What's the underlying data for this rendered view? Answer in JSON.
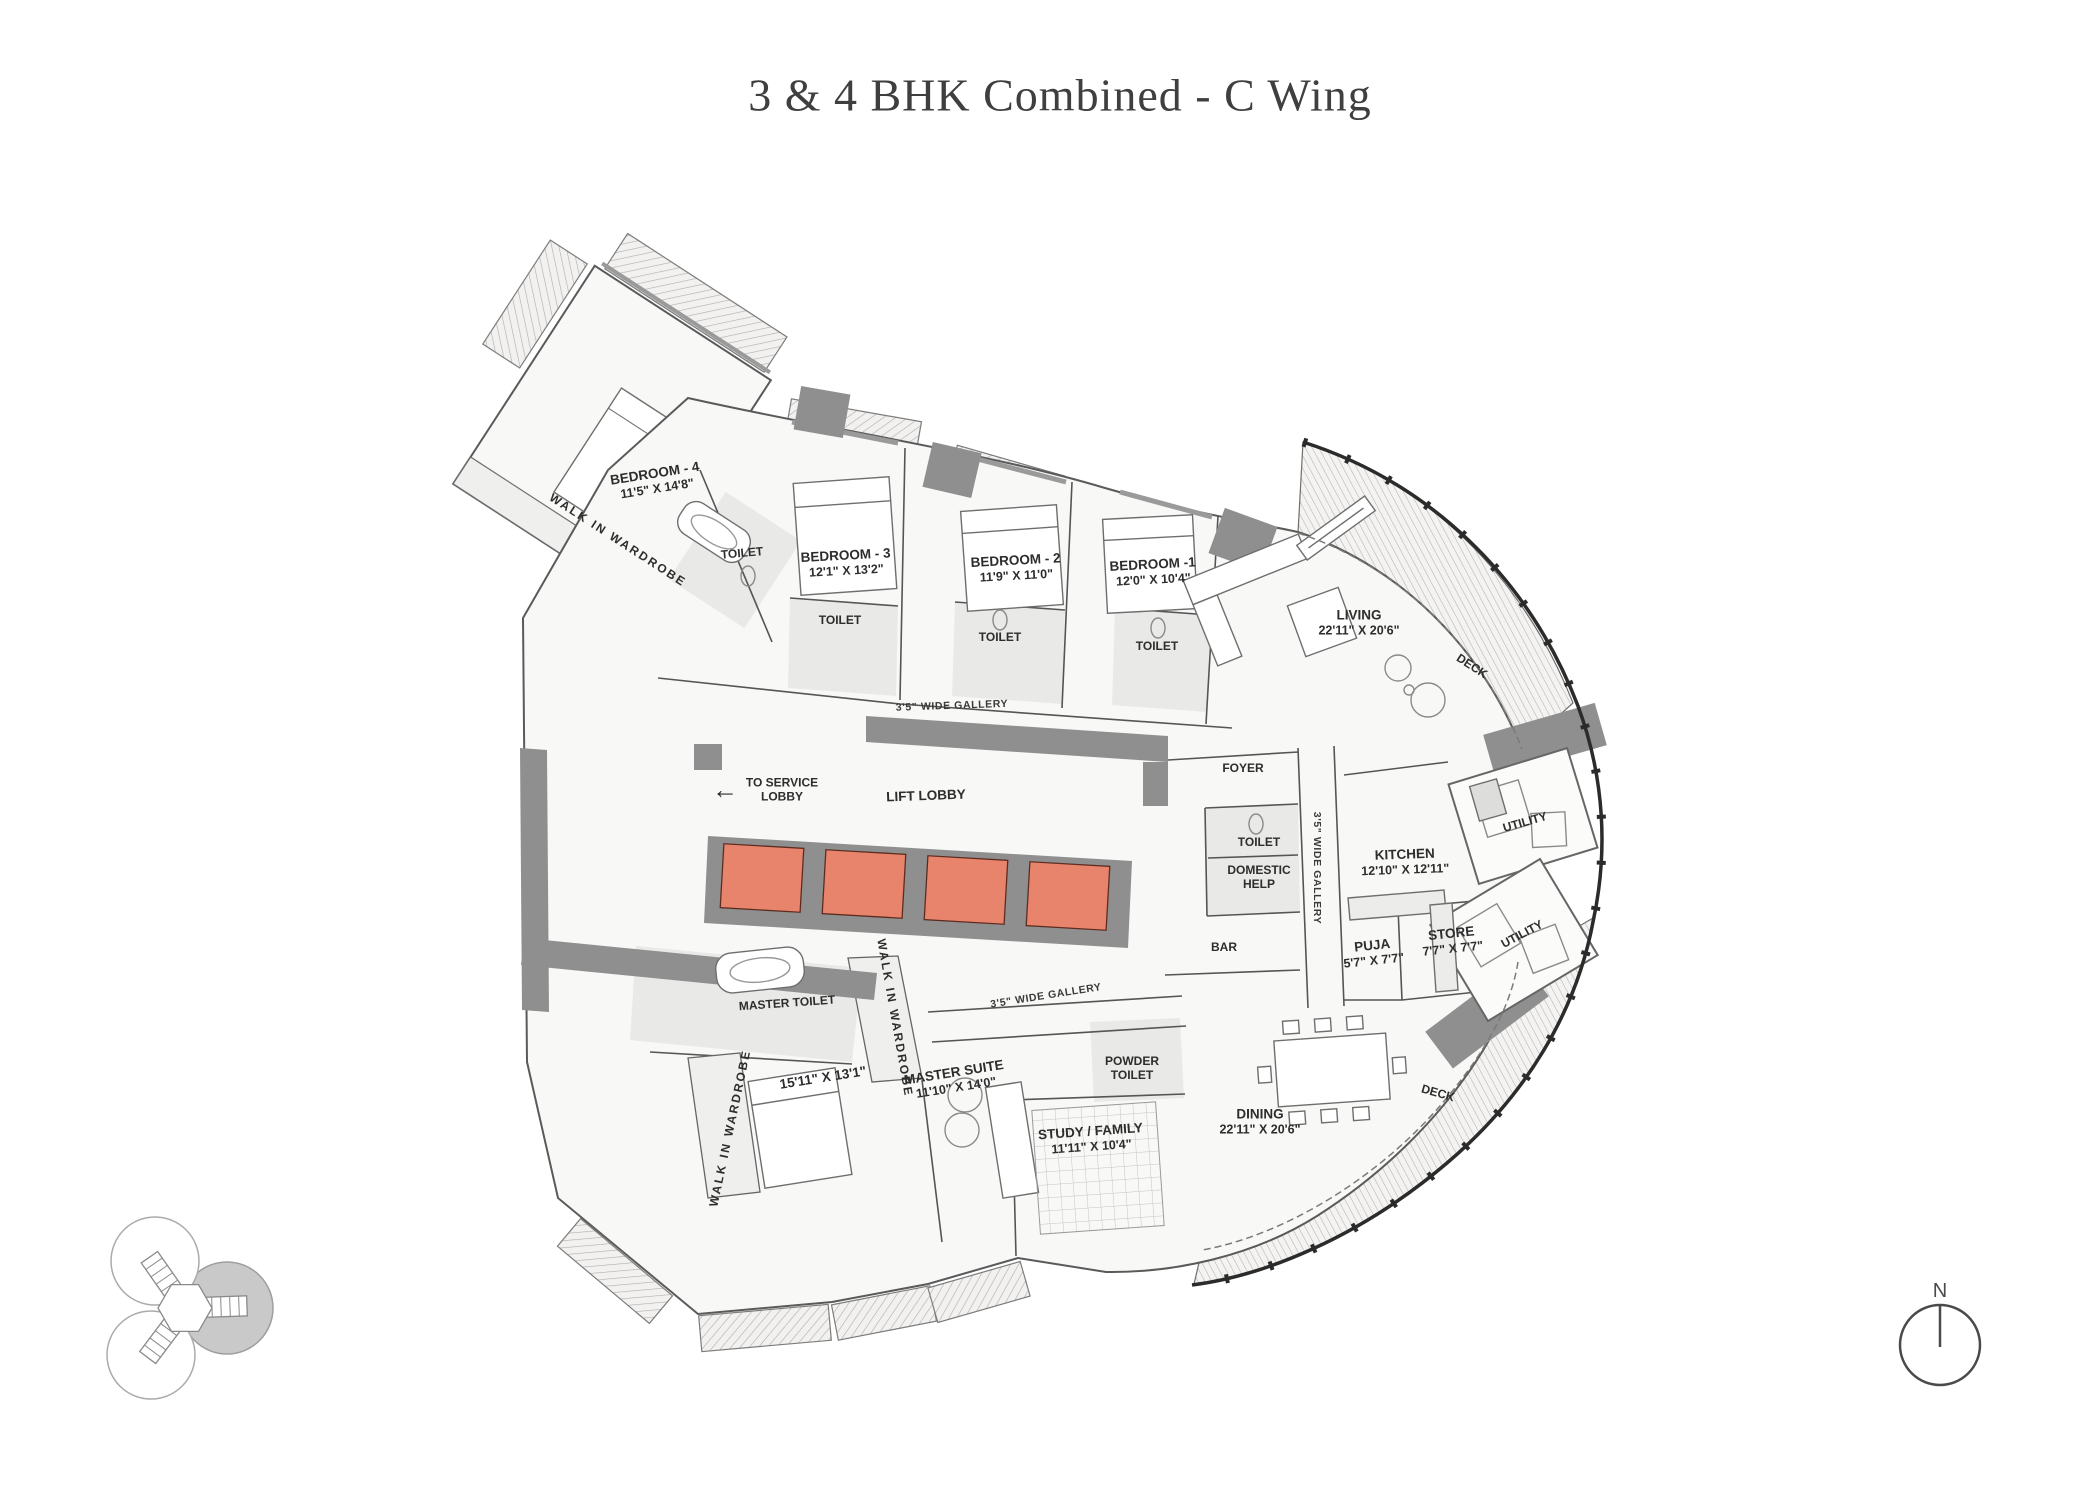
{
  "title": "3 & 4 BHK Combined - C Wing",
  "colors": {
    "lift_highlight": "#E8846B",
    "wall_gray": "#8F8F8F",
    "keyplan_wing_highlight": "#C9C9C9"
  },
  "icons": {
    "service_lobby_arrow": "←"
  },
  "labels": {
    "bedroom4": {
      "name": "BEDROOM - 4",
      "dims": "11'5\" X 14'8\""
    },
    "bedroom3": {
      "name": "BEDROOM - 3",
      "dims": "12'1\" X 13'2\""
    },
    "bedroom2": {
      "name": "BEDROOM - 2",
      "dims": "11'9\" X 11'0\""
    },
    "bedroom1": {
      "name": "BEDROOM -1",
      "dims": "12'0\" X 10'4\""
    },
    "living": {
      "name": "LIVING",
      "dims": "22'11\" X 20'6\""
    },
    "dining": {
      "name": "DINING",
      "dims": "22'11\" X 20'6\""
    },
    "kitchen": {
      "name": "KITCHEN",
      "dims": "12'10\" X 12'11\""
    },
    "store": {
      "name": "STORE",
      "dims": "7'7\" X 7'7\""
    },
    "puja": {
      "name": "PUJA",
      "dims": "5'7\" X 7'7\""
    },
    "master_suite": {
      "name": "MASTER SUITE",
      "dims": "11'10\" X 14'0\""
    },
    "master_bedroom_dims": "15'11\" X 13'1\"",
    "study_family": {
      "name": "STUDY / FAMILY",
      "dims": "11'11\" X 10'4\""
    },
    "master_toilet": "MASTER TOILET",
    "powder_toilet_line1": "POWDER",
    "powder_toilet_line2": "TOILET",
    "domestic_help_line1": "DOMESTIC",
    "domestic_help_line2": "HELP",
    "toilet": "TOILET",
    "bar": "BAR",
    "foyer": "FOYER",
    "deck": "DECK",
    "utility": "UTILITY",
    "lift_lobby": "LIFT LOBBY",
    "to_service_lobby_line1": "TO SERVICE",
    "to_service_lobby_line2": "LOBBY",
    "walk_in_wardrobe": "WALK IN WARDROBE",
    "wide_gallery": "3'5\" WIDE GALLERY",
    "north": "N"
  }
}
